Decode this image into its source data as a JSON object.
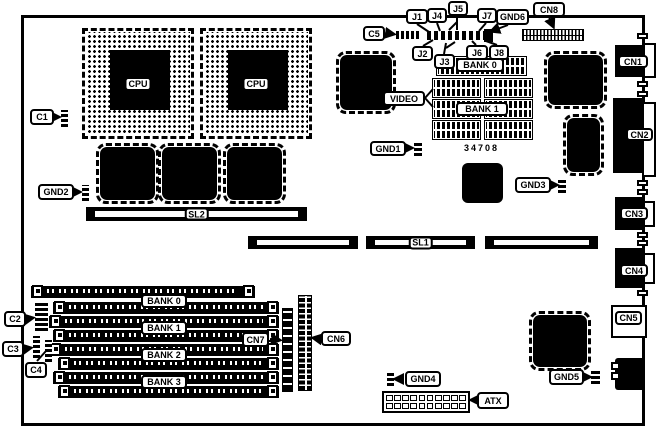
{
  "colors": {
    "ink": "#000000",
    "paper": "#ffffff"
  },
  "cpu": {
    "label": "CPU"
  },
  "top_jumpers": {
    "j1": "J1",
    "j2": "J2",
    "j3": "J3",
    "j4": "J4",
    "j5": "J5",
    "j6": "J6",
    "j7": "J7",
    "j8": "J8",
    "c5": "C5",
    "gnd6": "GND6",
    "cn8": "CN8"
  },
  "memory_top": {
    "bank0": "BANK 0",
    "bank1": "BANK 1",
    "part_number": "34708",
    "video": "VIDEO",
    "gnd1": "GND1"
  },
  "slots": {
    "sl1": "SL1",
    "sl2": "SL2"
  },
  "left": {
    "c1": "C1",
    "c2": "C2",
    "c3": "C3",
    "c4": "C4",
    "gnd2": "GND2"
  },
  "simm": {
    "bank0": "BANK 0",
    "bank1": "BANK 1",
    "bank2": "BANK 2",
    "bank3": "BANK 3",
    "cn6": "CN6",
    "cn7": "CN7"
  },
  "right": {
    "cn1": "CN1",
    "cn2": "CN2",
    "cn3": "CN3",
    "cn4": "CN4",
    "cn5": "CN5",
    "gnd3": "GND3",
    "gnd5": "GND5"
  },
  "bottom": {
    "gnd4": "GND4",
    "atx": "ATX"
  }
}
